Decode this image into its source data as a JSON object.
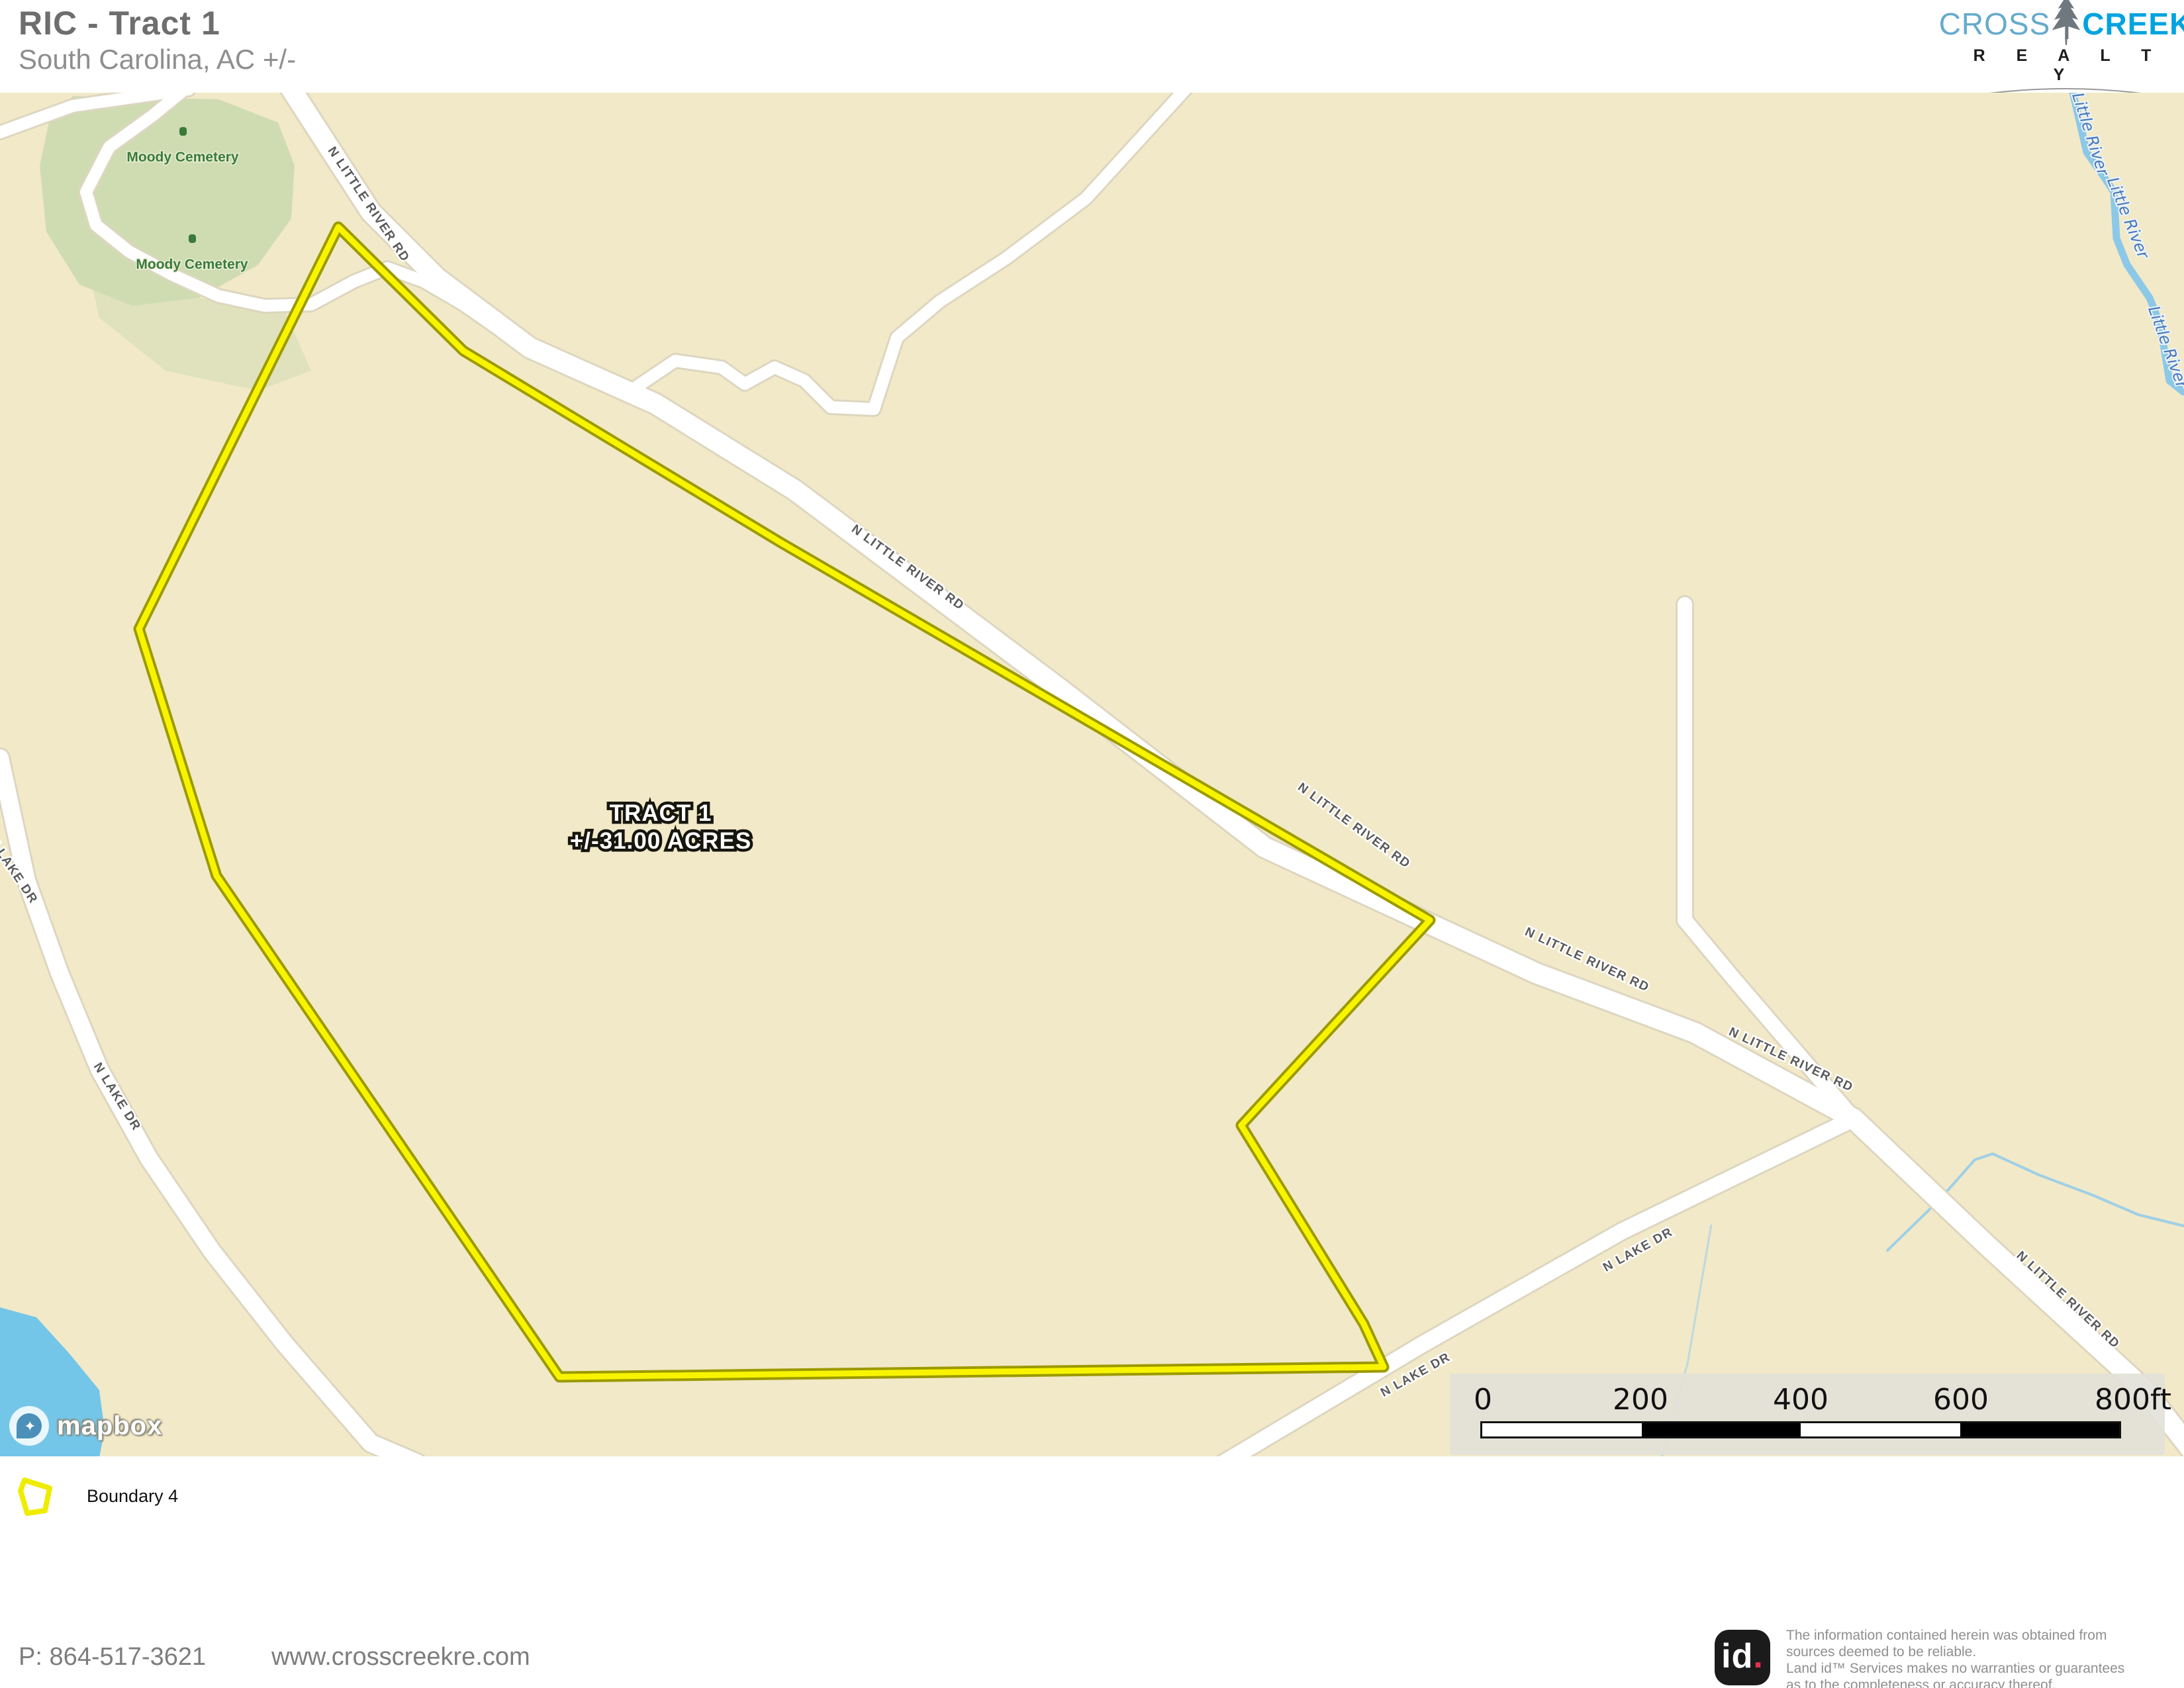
{
  "header": {
    "title": "RIC - Tract 1",
    "subtitle": "South Carolina,  AC +/-"
  },
  "brand": {
    "cross": "CROSS",
    "creek": "CREEK",
    "realty": "R E A L T Y",
    "llc": "L L C"
  },
  "map": {
    "tract": {
      "name": "TRACT 1",
      "acreage": "+/-31.00 ACRES"
    },
    "labels": {
      "little_river_rd": "N LITTLE RIVER RD",
      "lake_dr": "N LAKE DR",
      "river": "Little River",
      "cemetery": "Moody Cemetery"
    },
    "scale": {
      "labels": [
        "0",
        "200",
        "400",
        "600",
        "800ft"
      ]
    },
    "attribution": "mapbox"
  },
  "legend": {
    "items": [
      {
        "label": "Boundary 4"
      }
    ]
  },
  "footer": {
    "phone": "P: 864-517-3621",
    "website": "www.crosscreekre.com",
    "landid": {
      "id": "id",
      "dot": "."
    },
    "disclaimer_lines": [
      "The information contained herein was obtained from",
      "sources deemed to be reliable.",
      "Land id™  Services makes no warranties or guarantees",
      "as to the completeness or accuracy thereof."
    ]
  },
  "theme": {
    "land": "#f2e9c8",
    "water": "#74c6e8",
    "river": "#8cc8e8",
    "road": "#ffffff",
    "cemetery": "#cfdcb2",
    "boundary": "#f8f400",
    "boundary_casing": "#9c9a00",
    "road_label": "#5a5a5a",
    "water_label": "#4a77b8",
    "cemetery_label": "#3a7a3a",
    "header_text": "#6e6e6e",
    "brand_blue": "#00a3e0",
    "brand_light_blue": "#66aacd",
    "landid_red": "#e8304a"
  }
}
